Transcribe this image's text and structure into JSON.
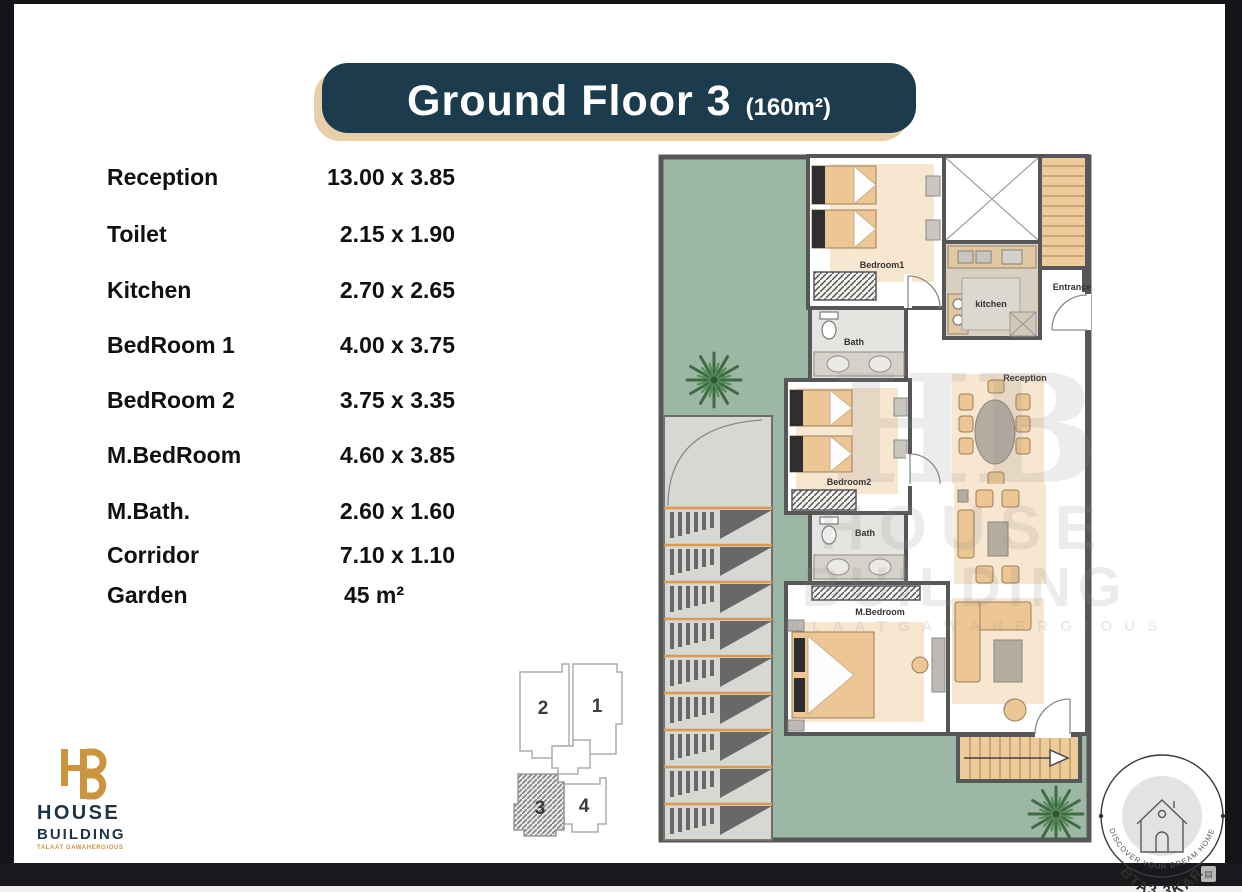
{
  "title": {
    "main": "Ground Floor 3",
    "area": "(160m²)"
  },
  "room_table": {
    "rows": [
      {
        "name": "Reception",
        "dims": "13.00 x 3.85"
      },
      {
        "name": "Toilet",
        "dims": "2.15 x 1.90"
      },
      {
        "name": "Kitchen",
        "dims": "2.70 x 2.65"
      },
      {
        "name": "BedRoom 1",
        "dims": "4.00 x 3.75"
      },
      {
        "name": "BedRoom 2",
        "dims": "3.75 x 3.35"
      },
      {
        "name": "M.BedRoom",
        "dims": "4.60 x 3.85"
      },
      {
        "name": "M.Bath.",
        "dims": "2.60 x 1.60"
      },
      {
        "name": "Corridor",
        "dims": "7.10 x 1.10"
      },
      {
        "name": "Garden",
        "dims": "45 m²"
      }
    ]
  },
  "plan": {
    "labels": {
      "bedroom1": "Bedroom1",
      "bath1": "Bath",
      "kitchen": "kitchen",
      "entrance": "Entrance",
      "reception": "Reception",
      "bedroom2": "Bedroom2",
      "bath2": "Bath",
      "m_bedroom": "M.Bedroom"
    }
  },
  "keyplan": {
    "unit1": "1",
    "unit2": "2",
    "unit3": "3",
    "unit4": "4"
  },
  "logo": {
    "monogram": "HB",
    "name_line1": "HOUSE",
    "name_line2": "BUILDING",
    "tagline": "TALAAT GAWAHERGIOUS"
  },
  "watermark": {
    "monogram": "HB",
    "line1": "HOUSE",
    "line2": "BUILDING",
    "line3": "T A L A A T   G A W A H E R G I O U S"
  },
  "badge": {
    "arc_top": "BTA3 3KAR",
    "arc_bottom": "DISCOVER YOUR DREAM HOME"
  },
  "icons": {
    "thumbnail": "▤"
  },
  "colors": {
    "banner_bg": "#1c3c4e",
    "banner_shadow": "#e9cfa7",
    "logo_gold": "#c9953e",
    "logo_navy": "#1d3347",
    "garden_green": "#9cb7a3",
    "wall_gray": "#575757",
    "furniture_tan": "#ecc694",
    "stairs_tan": "#eecb9b",
    "frame_dark": "#19191d"
  }
}
